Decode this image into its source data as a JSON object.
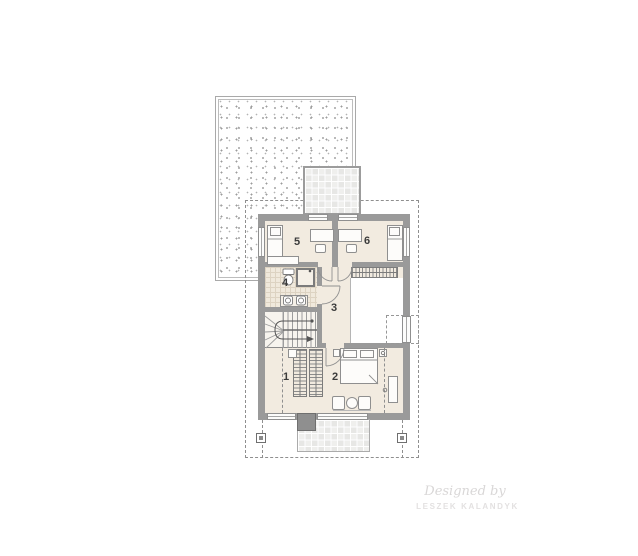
{
  "floor_plan": {
    "rooms": [
      {
        "number": "1"
      },
      {
        "number": "2"
      },
      {
        "number": "3"
      },
      {
        "number": "4"
      },
      {
        "number": "5"
      },
      {
        "number": "6"
      }
    ],
    "watermark": {
      "script_line": "Designed by",
      "brand_line": "LESZEK KALANDYK"
    },
    "colors": {
      "background": "#ffffff",
      "wall": "#9a9a9a",
      "floor": "#f2ebe0",
      "bathroom_tile": "#f0e9dc",
      "balcony_grid": "#ebebea",
      "stipple_dot": "#a6a6a6",
      "dashed_line": "#8f8f8f",
      "room_label": "#3b3b3b",
      "watermark": "#d9d7d7"
    }
  }
}
